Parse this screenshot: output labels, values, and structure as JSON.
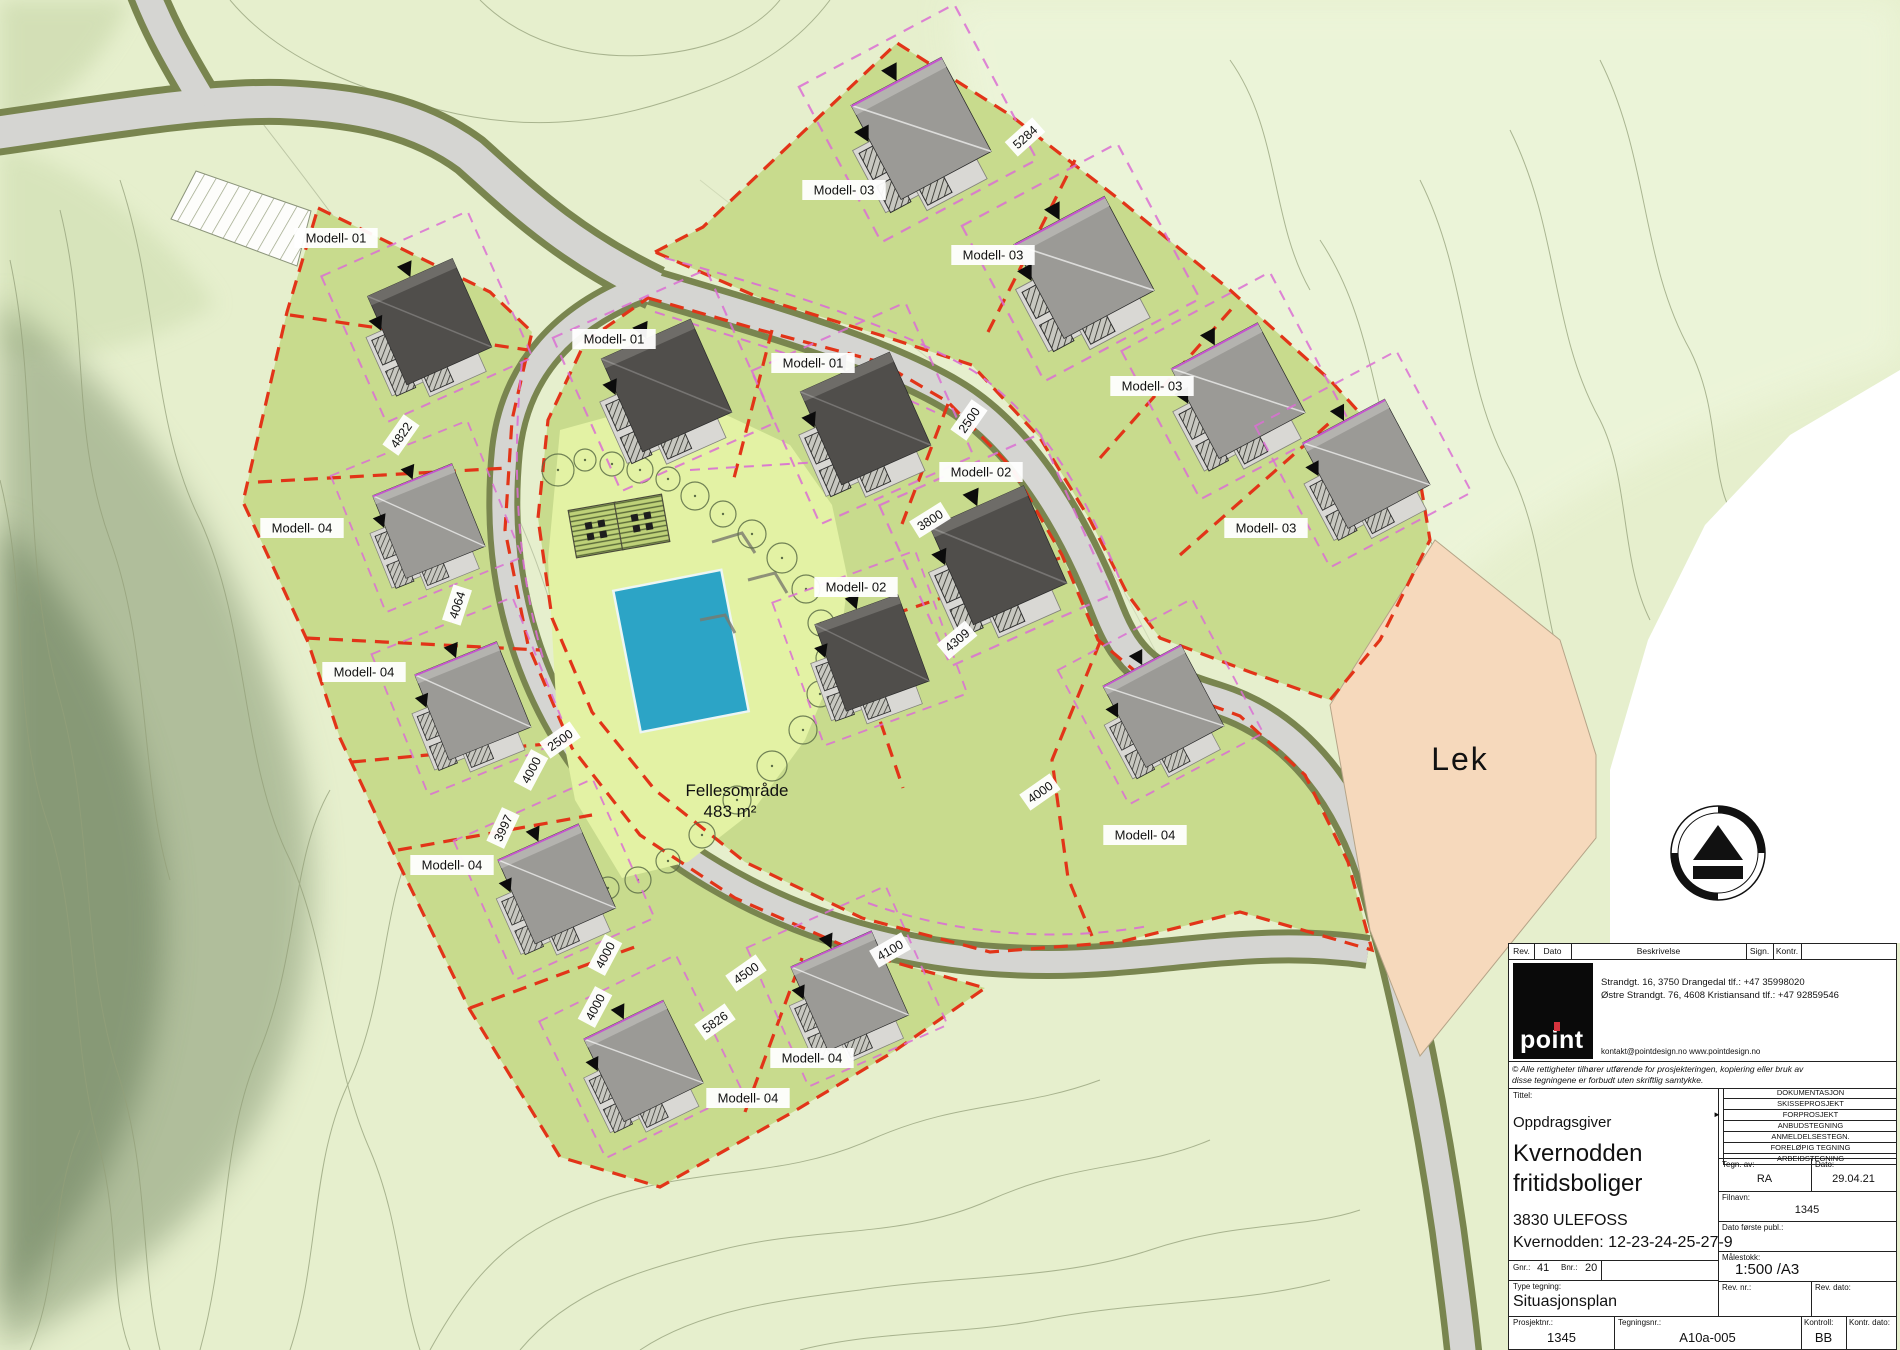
{
  "drawing": {
    "site": {
      "lek_label": "Lek",
      "common_area_label_line1": "Fellesområde",
      "common_area_label_line2": "483 m²",
      "lot_labels": [
        {
          "t": "Modell- 01",
          "x": 336,
          "y": 238
        },
        {
          "t": "Modell- 01",
          "x": 614,
          "y": 339
        },
        {
          "t": "Modell- 01",
          "x": 813,
          "y": 363
        },
        {
          "t": "Modell- 03",
          "x": 844,
          "y": 190
        },
        {
          "t": "Modell- 03",
          "x": 993,
          "y": 255
        },
        {
          "t": "Modell- 03",
          "x": 1152,
          "y": 386
        },
        {
          "t": "Modell- 03",
          "x": 1266,
          "y": 528
        },
        {
          "t": "Modell- 02",
          "x": 981,
          "y": 472
        },
        {
          "t": "Modell- 02",
          "x": 856,
          "y": 587
        },
        {
          "t": "Modell- 04",
          "x": 302,
          "y": 528
        },
        {
          "t": "Modell- 04",
          "x": 364,
          "y": 672
        },
        {
          "t": "Modell- 04",
          "x": 452,
          "y": 865
        },
        {
          "t": "Modell- 04",
          "x": 812,
          "y": 1058
        },
        {
          "t": "Modell- 04",
          "x": 748,
          "y": 1098
        },
        {
          "t": "Modell- 04",
          "x": 1145,
          "y": 835
        }
      ],
      "dimensions": [
        {
          "t": "4822",
          "x": 401,
          "y": 435,
          "r": -55
        },
        {
          "t": "4064",
          "x": 457,
          "y": 605,
          "r": -72
        },
        {
          "t": "2500",
          "x": 560,
          "y": 740,
          "r": -35
        },
        {
          "t": "4000",
          "x": 531,
          "y": 770,
          "r": -62
        },
        {
          "t": "3997",
          "x": 503,
          "y": 828,
          "r": -65
        },
        {
          "t": "4000",
          "x": 605,
          "y": 955,
          "r": -62
        },
        {
          "t": "4000",
          "x": 595,
          "y": 1007,
          "r": -62
        },
        {
          "t": "4500",
          "x": 746,
          "y": 973,
          "r": -35
        },
        {
          "t": "5826",
          "x": 715,
          "y": 1022,
          "r": -35
        },
        {
          "t": "4100",
          "x": 890,
          "y": 950,
          "r": -30
        },
        {
          "t": "2500",
          "x": 969,
          "y": 420,
          "r": -55
        },
        {
          "t": "3800",
          "x": 930,
          "y": 520,
          "r": -32
        },
        {
          "t": "4309",
          "x": 957,
          "y": 640,
          "r": -40
        },
        {
          "t": "4000",
          "x": 1040,
          "y": 792,
          "r": -35
        },
        {
          "t": "5284",
          "x": 1025,
          "y": 137,
          "r": -42
        }
      ],
      "houses": [
        {
          "model": "Modell-01",
          "x": 431,
          "y": 326,
          "rot": -24,
          "s": 1.0,
          "shade": "dark"
        },
        {
          "model": "Modell-01",
          "x": 668,
          "y": 390,
          "rot": -24,
          "s": 1.05,
          "shade": "dark"
        },
        {
          "model": "Modell-01",
          "x": 867,
          "y": 423,
          "rot": -24,
          "s": 1.05,
          "shade": "dark"
        },
        {
          "model": "Modell-02",
          "x": 1000,
          "y": 560,
          "rot": -24,
          "s": 1.1,
          "shade": "dark"
        },
        {
          "model": "Modell-02",
          "x": 873,
          "y": 657,
          "rot": -20,
          "s": 0.95,
          "shade": "dark"
        },
        {
          "model": "Modell-03",
          "x": 923,
          "y": 133,
          "rot": -28,
          "s": 1.1,
          "shade": "gray"
        },
        {
          "model": "Modell-03",
          "x": 1086,
          "y": 272,
          "rot": -28,
          "s": 1.1,
          "shade": "gray"
        },
        {
          "model": "Modell-03",
          "x": 1240,
          "y": 395,
          "rot": -28,
          "s": 1.05,
          "shade": "gray"
        },
        {
          "model": "Modell-03",
          "x": 1368,
          "y": 468,
          "rot": -28,
          "s": 1.0,
          "shade": "gray"
        },
        {
          "model": "Modell-04",
          "x": 430,
          "y": 525,
          "rot": -22,
          "s": 0.92,
          "shade": "gray"
        },
        {
          "model": "Modell-04",
          "x": 474,
          "y": 705,
          "rot": -22,
          "s": 0.95,
          "shade": "gray"
        },
        {
          "model": "Modell-04",
          "x": 558,
          "y": 888,
          "rot": -24,
          "s": 0.95,
          "shade": "gray"
        },
        {
          "model": "Modell-04",
          "x": 645,
          "y": 1065,
          "rot": -26,
          "s": 0.95,
          "shade": "gray"
        },
        {
          "model": "Modell-04",
          "x": 851,
          "y": 995,
          "rot": -24,
          "s": 0.95,
          "shade": "gray"
        },
        {
          "model": "Modell-04",
          "x": 1165,
          "y": 710,
          "rot": -28,
          "s": 0.95,
          "shade": "gray"
        }
      ]
    },
    "title_block": {
      "rev_header": {
        "rev": "Rev.",
        "dato": "Dato",
        "beskrivelse": "Beskrivelse",
        "sign": "Sign.",
        "kontr": "Kontr."
      },
      "logo_text": "point",
      "address_line1": "Strandgt. 16, 3750 Drangedal tlf.: +47 35998020",
      "address_line2": "Østre Strandgt. 76, 4608 Kristiansand tlf.: +47 92859546",
      "contact_line": "kontakt@pointdesign.no www.pointdesign.no",
      "copyright_line1": "© Alle rettigheter tilhører utførende for prosjekteringen, kopiering eller bruk av",
      "copyright_line2": "disse tegningene er forbudt uten skriftlig samtykke.",
      "tittel_label": "Tittel:",
      "client_label": "Oppdragsgiver",
      "project_name_line1": "Kvernodden",
      "project_name_line2": "fritidsboliger",
      "project_address": "3830 ULEFOSS",
      "project_plots": "Kvernodden: 12-23-24-25-27-9",
      "gnr_label": "Gnr.:",
      "gnr": "41",
      "bnr_label": "Bnr.:",
      "bnr": "20",
      "type_label": "Type tegning:",
      "type_value": "Situasjonsplan",
      "prosjektnr_label": "Prosjektnr.:",
      "prosjektnr": "1345",
      "tegningsnr_label": "Tegningsnr.:",
      "tegningsnr": "A10a-005",
      "kontroll_label": "Kontroll:",
      "kontroll": "BB",
      "kontr_dato_label": "Kontr. dato:",
      "checklist_marker": "►",
      "checklist": [
        {
          "label": "DOKUMENTASJON",
          "active": false
        },
        {
          "label": "SKISSEPROSJEKT",
          "active": false
        },
        {
          "label": "FORPROSJEKT",
          "active": true
        },
        {
          "label": "ANBUDSTEGNING",
          "active": false
        },
        {
          "label": "ANMELDELSESTEGN.",
          "active": false
        },
        {
          "label": "FORELØPIG TEGNING",
          "active": false
        },
        {
          "label": "ARBEIDSTEGNING",
          "active": false
        }
      ],
      "tegn_av_label": "Tegn. av:",
      "tegn_av": "RA",
      "dato_label": "Dato:",
      "dato": "29.04.21",
      "filnavn_label": "Filnavn:",
      "filnavn": "1345",
      "dato_forste_label": "Dato første publ.:",
      "malestokk_label": "Målestokk:",
      "malestokk": "1:500 /A3",
      "rev_nr_label": "Rev. nr.:",
      "rev_dato_label": "Rev. dato:"
    },
    "colors": {
      "lot_green": "#c8db8d",
      "common_green": "#e3f2a4",
      "road_gray": "#d5d5d2",
      "road_edge": "#79854f",
      "boundary_red": "#e23418",
      "setback_pink": "#da6fd4",
      "pool_blue": "#2ca4c6",
      "play_area_peach": "#f6d9bc"
    }
  }
}
